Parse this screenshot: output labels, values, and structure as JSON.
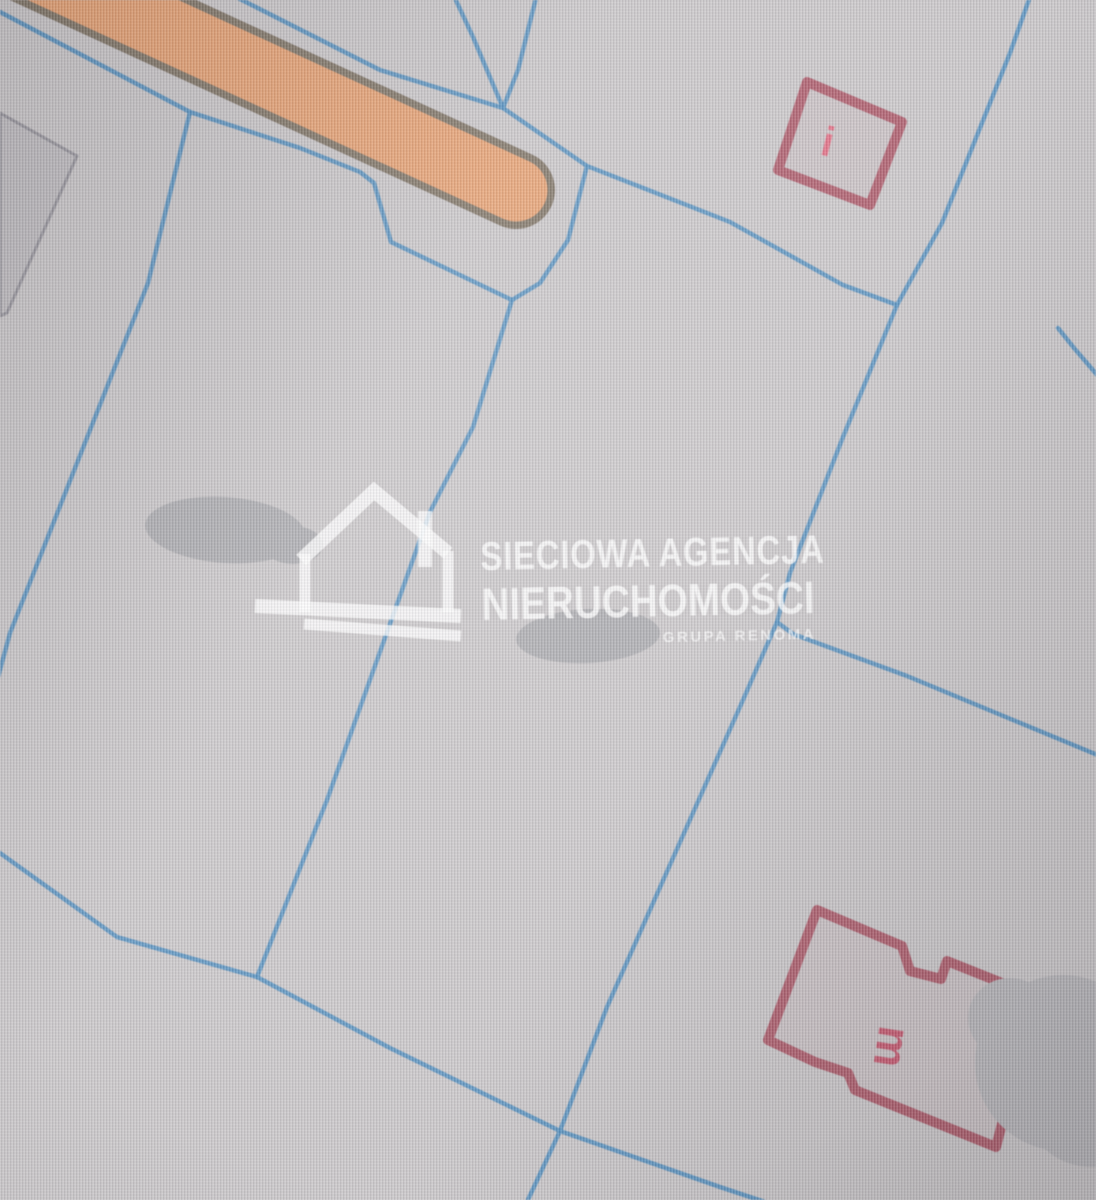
{
  "watermark": {
    "line1": "SIECIOWA AGENCJA",
    "line2": "NIERUCHOMOŚCI",
    "line3": "GRUPA RENOMA"
  },
  "map": {
    "labels": {
      "building_i": "i",
      "building_m": "m"
    }
  },
  "colors": {
    "background": "#c8c5c7",
    "parcel_line": "#4c8bbd",
    "road_fill": "#e69e6e",
    "road_border": "#6f6150",
    "building_outline": "#aa5262",
    "building_label": "#c4526a",
    "watermark_text": "#ffffff",
    "redaction_blob": "#a9a9ad"
  }
}
